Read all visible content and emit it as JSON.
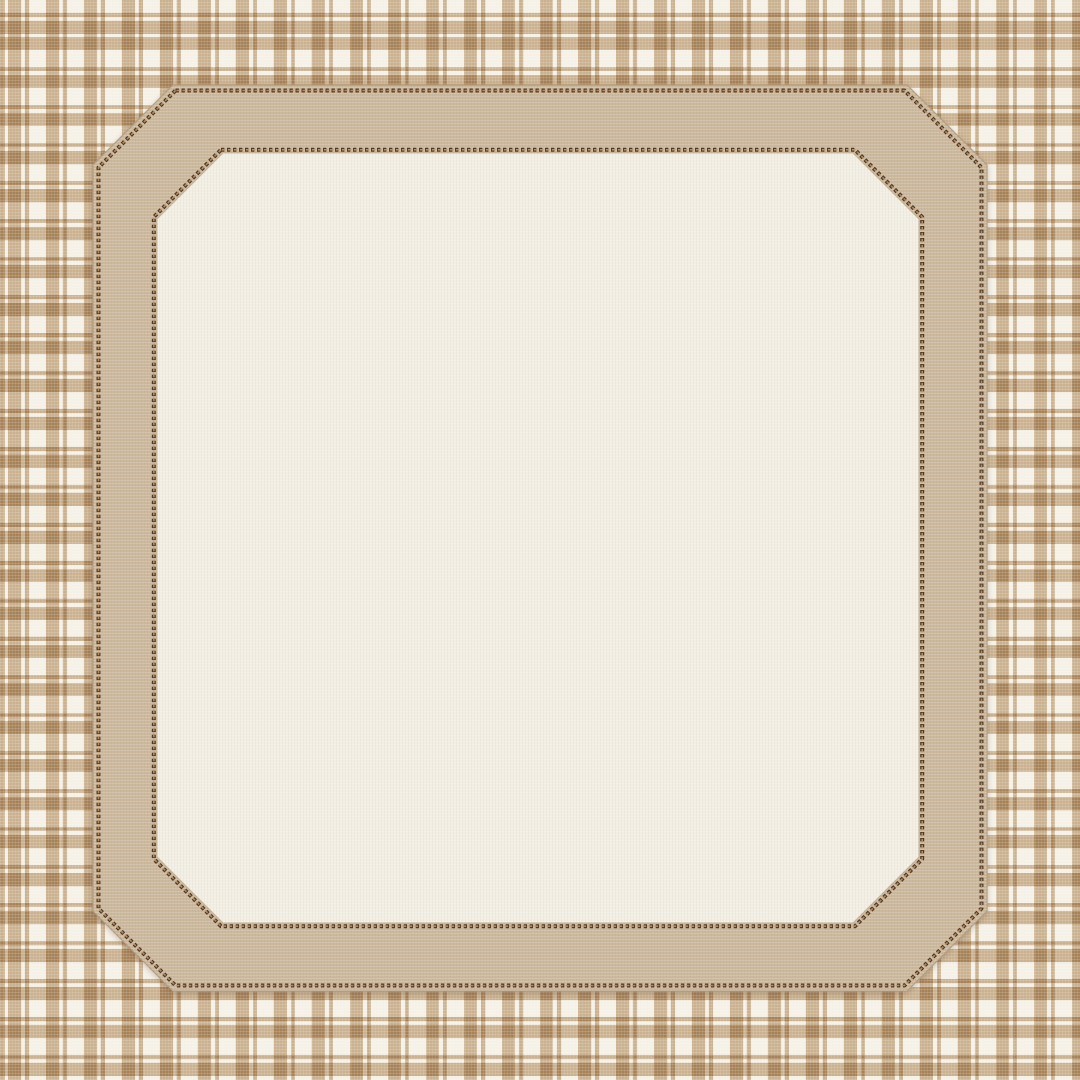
{
  "scene": {
    "type": "decorative-frame-graphic",
    "components": {
      "background": "plaid-fabric-background",
      "frame": "octagonal-stitched-fabric-frame",
      "panel": "blank-linen-inner-panel",
      "borders": "beaded-stitch-lines"
    }
  },
  "colors": {
    "plaid_base": "#f5f1e7",
    "plaid_stripe": "#d2bb9e",
    "frame": "#ccb89d",
    "frame_edge": "#b39d7f",
    "panel": "#f2eee3",
    "panel_edge": "#c4b193",
    "stitch_dark": "#4f3b27",
    "stitch_light": "#bd9468"
  }
}
